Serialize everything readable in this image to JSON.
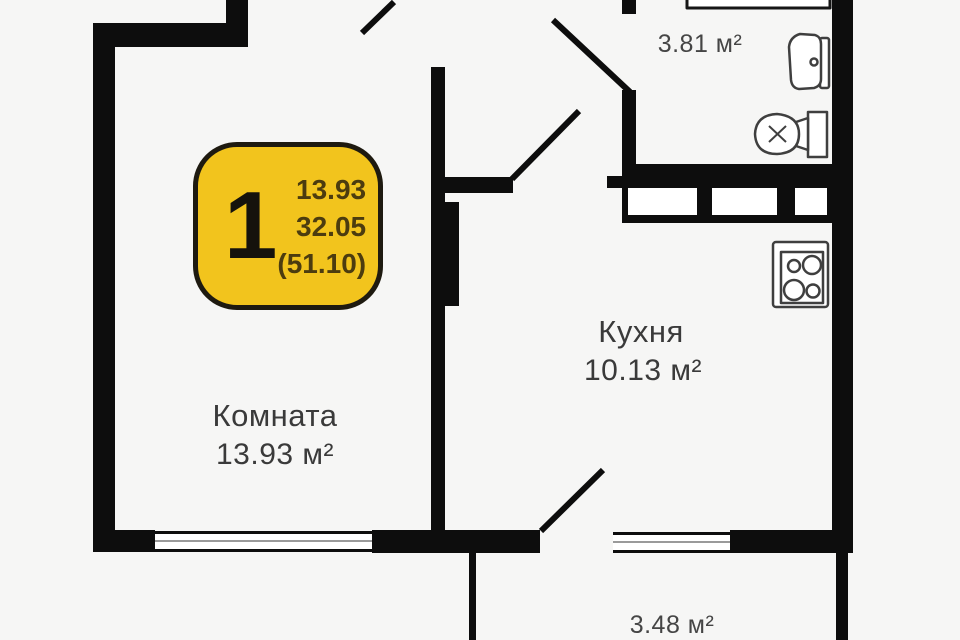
{
  "plan": {
    "badge": {
      "room_count": "1",
      "lines": [
        "13.93",
        "32.05",
        "(51.10)"
      ]
    },
    "rooms": {
      "living": {
        "name": "Комната",
        "area": "13.93 м²"
      },
      "kitchen": {
        "name": "Кухня",
        "area": "10.13 м²"
      },
      "bathroom": {
        "area": "3.81 м²"
      },
      "balcony": {
        "area": "3.48 м²"
      }
    },
    "colors": {
      "bg": "#f6f6f5",
      "wall": "#0d0d0d",
      "badge": "#f2c41d",
      "badge-text": "#4c3c0f",
      "text": "#3a3a3a"
    }
  }
}
